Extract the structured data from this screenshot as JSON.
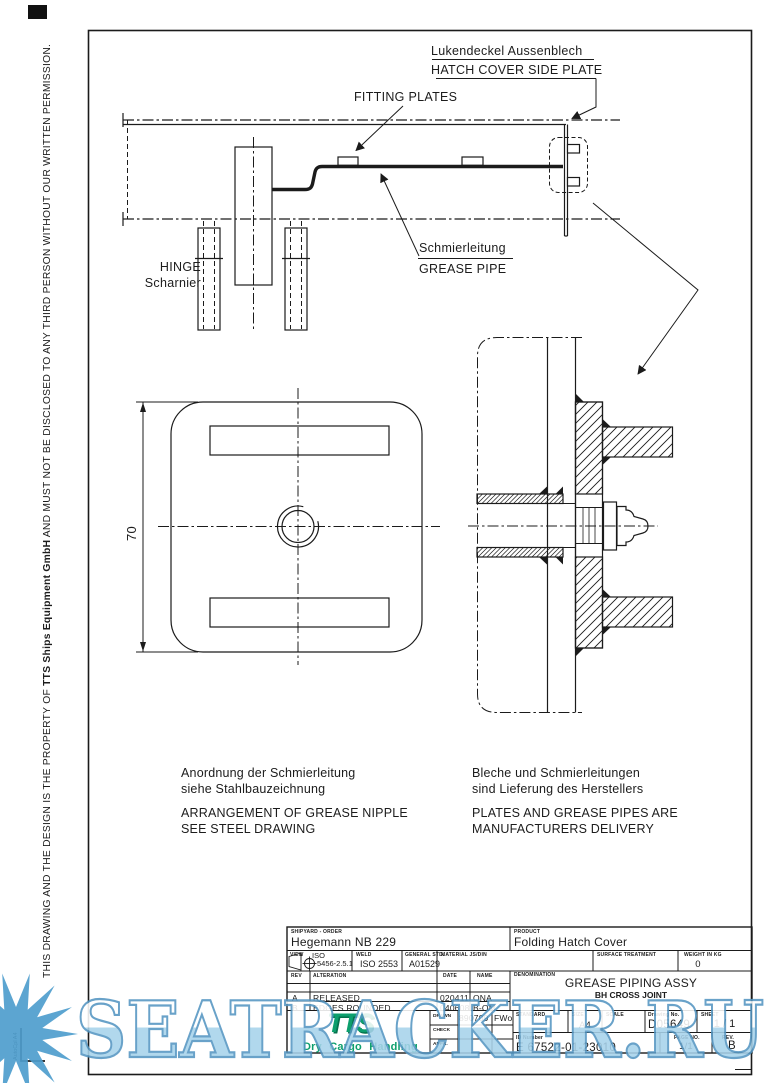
{
  "sidebar": {
    "notice_part1": "THIS DRAWING AND THE DESIGN IS THE PROPERTY OF ",
    "notice_company": "TTS Ships Equipment GmbH",
    "notice_part2": " AND MUST NOT BE DISCLOSED TO ANY THIRD PERSON WITHOUT OUR WRITTEN PERMISSION.",
    "corner_mark": "AutoCpl  A4"
  },
  "drawing": {
    "labels": {
      "side_plate_de": "Lukendeckel Aussenblech",
      "side_plate_en": "HATCH COVER SIDE PLATE",
      "fitting_plates": "FITTING PLATES",
      "hinge_en": "HINGE",
      "hinge_de": "Scharnier",
      "grease_pipe_de": "Schmierleitung",
      "grease_pipe_en": "GREASE PIPE",
      "dimension_70": "70"
    },
    "notes": {
      "left_de1": "Anordnung der Schmierleitung",
      "left_de2": "siehe Stahlbauzeichnung",
      "left_en1": "ARRANGEMENT OF GREASE NIPPLE",
      "left_en2": "SEE STEEL DRAWING",
      "right_de1": "Bleche und Schmierleitungen",
      "right_de2": "sind Lieferung des Herstellers",
      "right_en1": "PLATES AND GREASE PIPES ARE",
      "right_en2": "MANUFACTURERS DELIVERY"
    }
  },
  "title_block": {
    "shipyard": {
      "label": "SHIPYARD - ORDER",
      "value": "Hegemann NB 229"
    },
    "product": {
      "label": "PRODUCT",
      "value": "Folding Hatch Cover"
    },
    "view": {
      "label": "VIEW",
      "line1": "ISO",
      "line2": "5456-2.5.1"
    },
    "weld": {
      "label": "WELD",
      "value": "ISO 2553"
    },
    "general_std": {
      "label": "GENERAL STD.",
      "value": "A01529"
    },
    "material": {
      "label": "MATERIAL JS/DIN"
    },
    "surface": {
      "label": "SURFACE TREATMENT"
    },
    "weight": {
      "label": "WEIGHT IN KG",
      "value": "0"
    },
    "rev_table": {
      "headers": {
        "rev": "REV",
        "alteration": "ALTERATION",
        "date": "DATE",
        "name": "NAME"
      },
      "rows": [
        {
          "rev": "A",
          "alteration": "RELEASED",
          "date": "020411",
          "name": "ONA"
        },
        {
          "rev": "B",
          "alteration": "EDGES ROUNDED",
          "date": "040608",
          "name": "B-OM"
        }
      ]
    },
    "denomination": {
      "label": "DENOMINATION",
      "line1": "GREASE PIPING ASSY",
      "line2": "BH CROSS JOINT"
    },
    "sign_table": {
      "drawn": {
        "label": "DRAWN",
        "date": "890709",
        "name": "FWo"
      },
      "check": {
        "label": "CHECK"
      },
      "appr": {
        "label": "APPR."
      }
    },
    "standard": {
      "label": "STANDARD"
    },
    "size": {
      "label": "SIZE",
      "value": "A4"
    },
    "scale": {
      "label": "SCALE"
    },
    "drawing_no": {
      "label": "Drawing No.",
      "value": "D05649"
    },
    "sheet": {
      "label": "SHEET",
      "value": "1 / 1"
    },
    "id_number": {
      "label": "ID Number",
      "value": "E 67522-01-23010"
    },
    "page_no": {
      "label": "PAGE NO.",
      "value": "1/1"
    },
    "rev": {
      "label": "REV.",
      "value": "B"
    },
    "logo": {
      "tts": "TTS",
      "tagline": "Dry Cargo Handling"
    }
  },
  "watermark": {
    "text": "SEATRACKER.RU",
    "fill": "#a7d3eb",
    "outline": "#5596c2",
    "sun": "#4e9dcd"
  },
  "colors": {
    "line": "#1b1b1b",
    "logo_green": "#0d9f6d"
  }
}
